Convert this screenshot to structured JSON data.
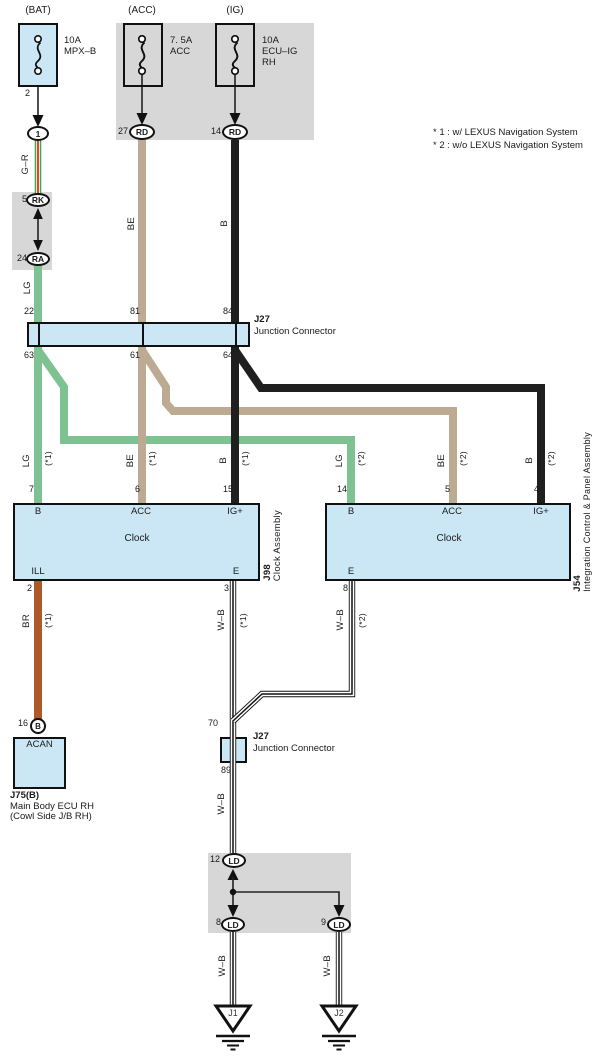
{
  "colors": {
    "light_blue": "#cbe7f5",
    "gray": "#d7d7d7",
    "lg_green": "#7ec292",
    "be_tan": "#bcab92",
    "b_black": "#1f1f1f",
    "br_brown": "#ad5a2a",
    "gr_green": "#2fae4b",
    "gr_red": "#ee3b33"
  },
  "notes": {
    "line1": "* 1 : w/ LEXUS Navigation System",
    "line2": "* 2 : w/o LEXUS Navigation System"
  },
  "fuses": {
    "bat": {
      "title": "(BAT)",
      "rating": "10A",
      "name": "MPX–B",
      "pin": "2"
    },
    "acc": {
      "title": "(ACC)",
      "rating": "7. 5A",
      "name": "ACC",
      "pin": "27",
      "terminal": "RD"
    },
    "ig": {
      "title": "(IG)",
      "rating": "10A",
      "name": "ECU–IG",
      "name2": "RH",
      "pin": "14",
      "terminal": "RD"
    }
  },
  "connector1": {
    "pin": "1"
  },
  "relay_block": {
    "pin_top": "5",
    "terminal_top": "RK",
    "pin_bottom": "24",
    "terminal_bottom": "RA"
  },
  "wires": {
    "gr": "G–R",
    "lg": "LG",
    "be": "BE",
    "b": "B",
    "br": "BR",
    "wb": "W–B",
    "s1": "(*1)",
    "s2": "(*2)"
  },
  "junction_top": {
    "id": "J27",
    "name": "Junction Connector",
    "pins_top": [
      "22",
      "81",
      "84"
    ],
    "pins_bottom": [
      "63",
      "61",
      "64"
    ]
  },
  "clock_left": {
    "pins_top": [
      "7",
      "6",
      "15"
    ],
    "pin_labels": [
      "B",
      "ACC",
      "IG+"
    ],
    "title": "Clock",
    "pin_ill": "ILL",
    "pin_ill_num": "2",
    "pin_e": "E",
    "pin_e_num": "3",
    "id": "J98",
    "name": "Clock Assembly"
  },
  "clock_right": {
    "pins_top": [
      "14",
      "5",
      "4"
    ],
    "pin_labels": [
      "B",
      "ACC",
      "IG+"
    ],
    "title": "Clock",
    "pin_e": "E",
    "pin_e_num": "8",
    "id": "J54",
    "name": "Integration Control & Panel Assembly"
  },
  "ecu": {
    "pin": "16",
    "terminal": "B",
    "block": "ACAN",
    "id": "J75(B)",
    "name1": "Main Body ECU RH",
    "name2": "(Cowl Side J/B RH)"
  },
  "junction_bottom": {
    "id": "J27",
    "name": "Junction Connector",
    "pin_top": "70",
    "pin_bottom": "89"
  },
  "ground_block": {
    "pin_in": "12",
    "terminal_in": "LD",
    "pin_out_left": "8",
    "terminal_out_left": "LD",
    "pin_out_right": "9",
    "terminal_out_right": "LD"
  },
  "grounds": {
    "left": "J1",
    "right": "J2"
  }
}
